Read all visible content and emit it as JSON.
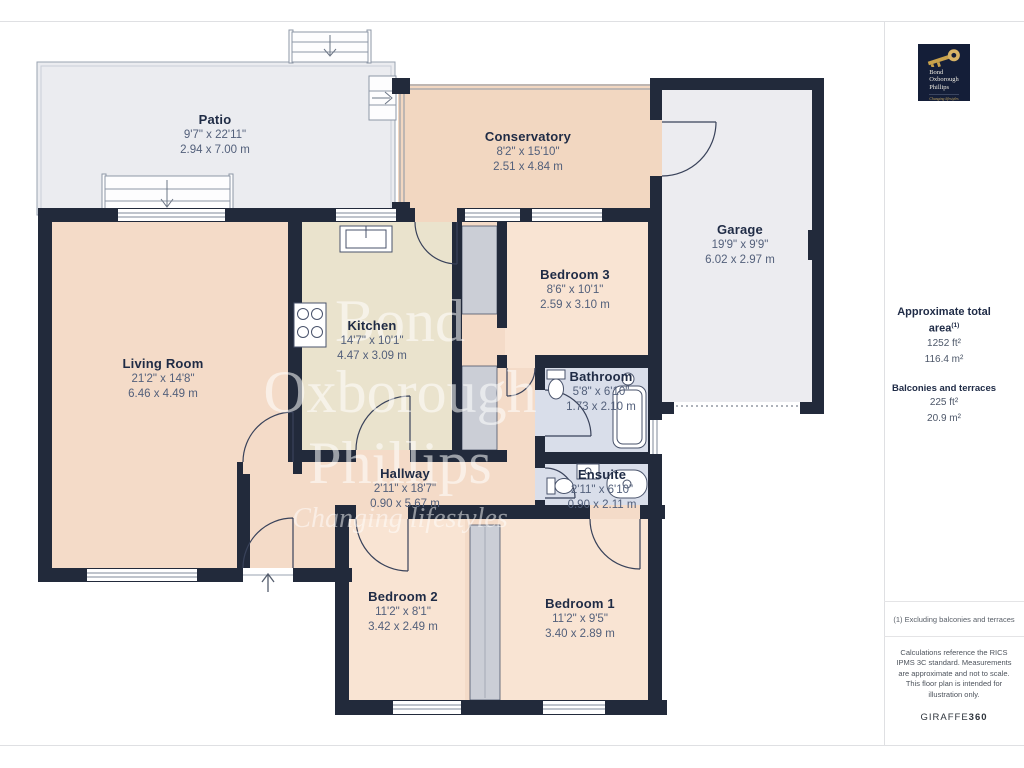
{
  "plan": {
    "rooms": [
      {
        "id": "patio",
        "name": "Patio",
        "imperial": "9'7\" x 22'11\"",
        "metric": "2.94 x 7.00 m"
      },
      {
        "id": "conservatory",
        "name": "Conservatory",
        "imperial": "8'2\" x 15'10\"",
        "metric": "2.51 x 4.84 m"
      },
      {
        "id": "garage",
        "name": "Garage",
        "imperial": "19'9\" x 9'9\"",
        "metric": "6.02 x 2.97 m"
      },
      {
        "id": "living-room",
        "name": "Living Room",
        "imperial": "21'2\" x 14'8\"",
        "metric": "6.46 x 4.49 m"
      },
      {
        "id": "kitchen",
        "name": "Kitchen",
        "imperial": "14'7\" x 10'1\"",
        "metric": "4.47 x 3.09 m"
      },
      {
        "id": "bedroom-3",
        "name": "Bedroom 3",
        "imperial": "8'6\" x 10'1\"",
        "metric": "2.59 x 3.10 m"
      },
      {
        "id": "bathroom",
        "name": "Bathroom",
        "imperial": "5'8\" x 6'10\"",
        "metric": "1.73 x 2.10 m"
      },
      {
        "id": "hallway",
        "name": "Hallway",
        "imperial": "2'11\" x 18'7\"",
        "metric": "0.90 x 5.67 m"
      },
      {
        "id": "ensuite",
        "name": "Ensuite",
        "imperial": "2'11\" x 6'10\"",
        "metric": "0.90 x 2.11 m"
      },
      {
        "id": "bedroom-2",
        "name": "Bedroom 2",
        "imperial": "11'2\" x 8'1\"",
        "metric": "3.42 x 2.49 m"
      },
      {
        "id": "bedroom-1",
        "name": "Bedroom 1",
        "imperial": "11'2\" x 9'5\"",
        "metric": "3.40 x 2.89 m"
      }
    ],
    "watermark": {
      "line1": "Bond",
      "line2": "Oxborough",
      "line3": "Phillips",
      "tagline": "Changing lifestyles"
    }
  },
  "sidebar": {
    "logo": {
      "line1": "Bond",
      "line2": "Oxborough",
      "line3": "Phillips",
      "tagline": "Changing lifestyles"
    },
    "total_area": {
      "heading": "Approximate total area",
      "footnote_marker": "(1)",
      "value_ft": "1252 ft²",
      "value_m": "116.4 m²"
    },
    "balconies": {
      "heading": "Balconies and terraces",
      "value_ft": "225 ft²",
      "value_m": "20.9 m²"
    },
    "footnote": "(1) Excluding balconies and terraces",
    "disclaimer": "Calculations reference the RICS IPMS 3C standard. Measurements are approximate and not to scale. This floor plan is intended for illustration only.",
    "brand": {
      "name": "GIRAFFE",
      "suffix": "360"
    }
  },
  "colors": {
    "wall": "#222a3b",
    "room_peach": "#f4dbc8",
    "room_peach_light": "#f9e4d3",
    "conservatory": "#f2d7c1",
    "kitchen": "#eae3cd",
    "wet_room": "#d9deea",
    "outdoor_gray": "#ebecf0",
    "closet_gray": "#cbced6",
    "logo_navy": "#141e38",
    "logo_gold": "#c9a24b"
  }
}
